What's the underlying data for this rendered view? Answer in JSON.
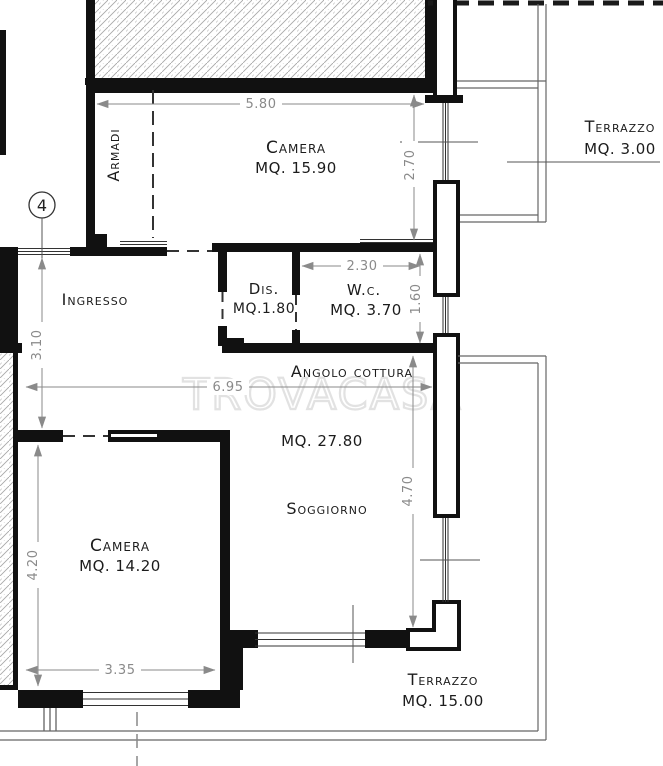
{
  "watermark": "trovacasa",
  "plan": {
    "unit_badge": "4",
    "rooms": {
      "camera_top": {
        "name": "Camera",
        "area": "MQ. 15.90"
      },
      "armadi": {
        "name": "Armadi"
      },
      "terrazzo_top": {
        "name": "Terrazzo",
        "area": "MQ. 3.00"
      },
      "ingresso": {
        "name": "Ingresso"
      },
      "dis": {
        "name": "Dis.",
        "area": "MQ.1.80"
      },
      "wc": {
        "name": "W.c.",
        "area": "MQ. 3.70"
      },
      "angolo_cottura": {
        "name": "Angolo cottura"
      },
      "soggiorno": {
        "name": "Soggiorno",
        "area": "MQ. 27.80"
      },
      "camera_bottom": {
        "name": "Camera",
        "area": "MQ. 14.20"
      },
      "terrazzo_bottom": {
        "name": "Terrazzo",
        "area": "MQ. 15.00"
      }
    },
    "dimensions": {
      "camera_top_width": "5.80",
      "camera_top_depth": "2.70",
      "ingresso_depth": "3.10",
      "wc_width": "2.30",
      "wc_depth": "1.60",
      "living_width": "6.95",
      "soggiorno_depth": "4.70",
      "camera_bottom_depth": "4.20",
      "camera_bottom_width": "3.35"
    }
  },
  "colors": {
    "wall": "#111111",
    "dimension": "#8a8a8a",
    "watermark": "#e2e2e2",
    "hatch": "#a8a8a8"
  }
}
